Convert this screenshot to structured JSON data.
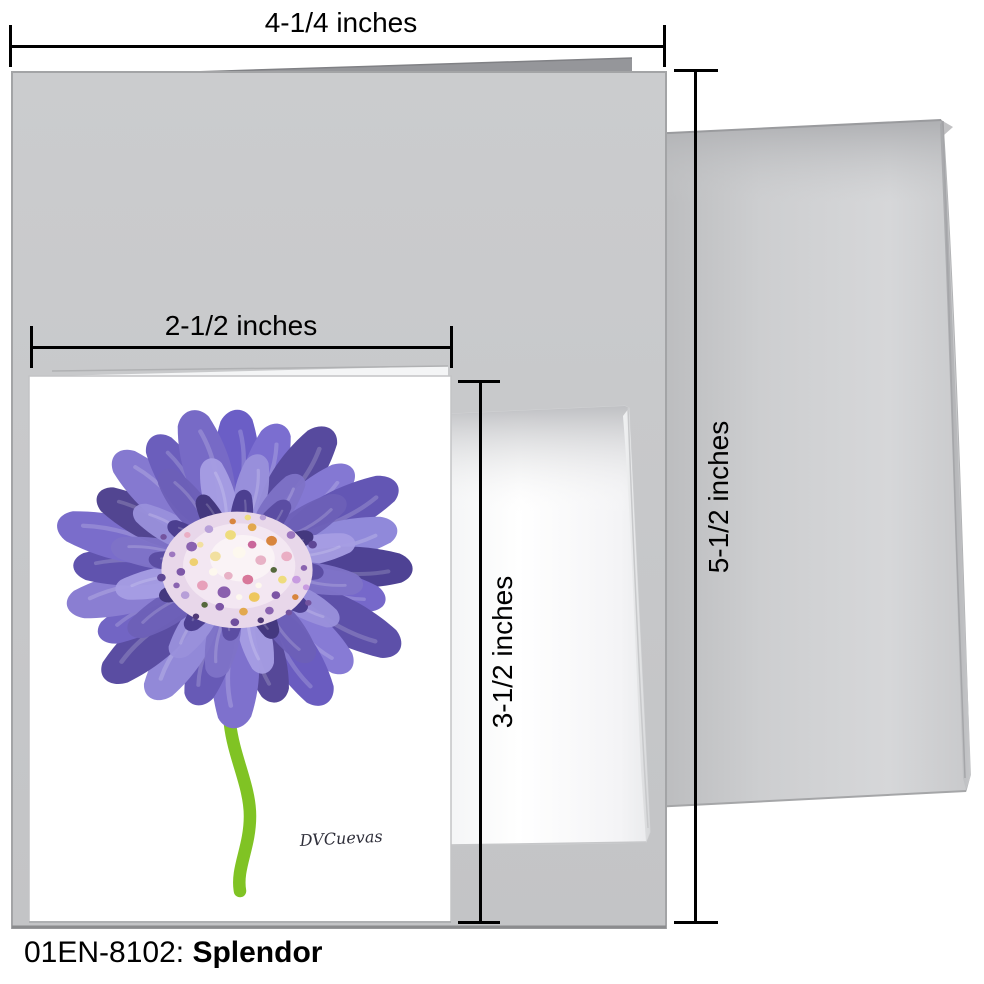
{
  "caption": {
    "code": "01EN-8102:",
    "title": "Splendor"
  },
  "dimensions": {
    "large_card_width": "4-1/4 inches",
    "large_card_height": "5-1/2 inches",
    "small_card_width": "2-1/2 inches",
    "small_card_height": "3-1/2 inches"
  },
  "artwork": {
    "signature": "DVCuevas"
  },
  "colors": {
    "large_card_gray": "#c7c8ca",
    "card_back_panel_gray": "#95969a",
    "envelope_gray": "#cdced0",
    "small_card_white": "#ffffff",
    "flower_petal_purple": "#6b5ec6",
    "flower_petal_dark": "#4e4294",
    "flower_center_pink": "#f3e7f2",
    "stem_green": "#80c324",
    "dimension_line_black": "#000000"
  }
}
